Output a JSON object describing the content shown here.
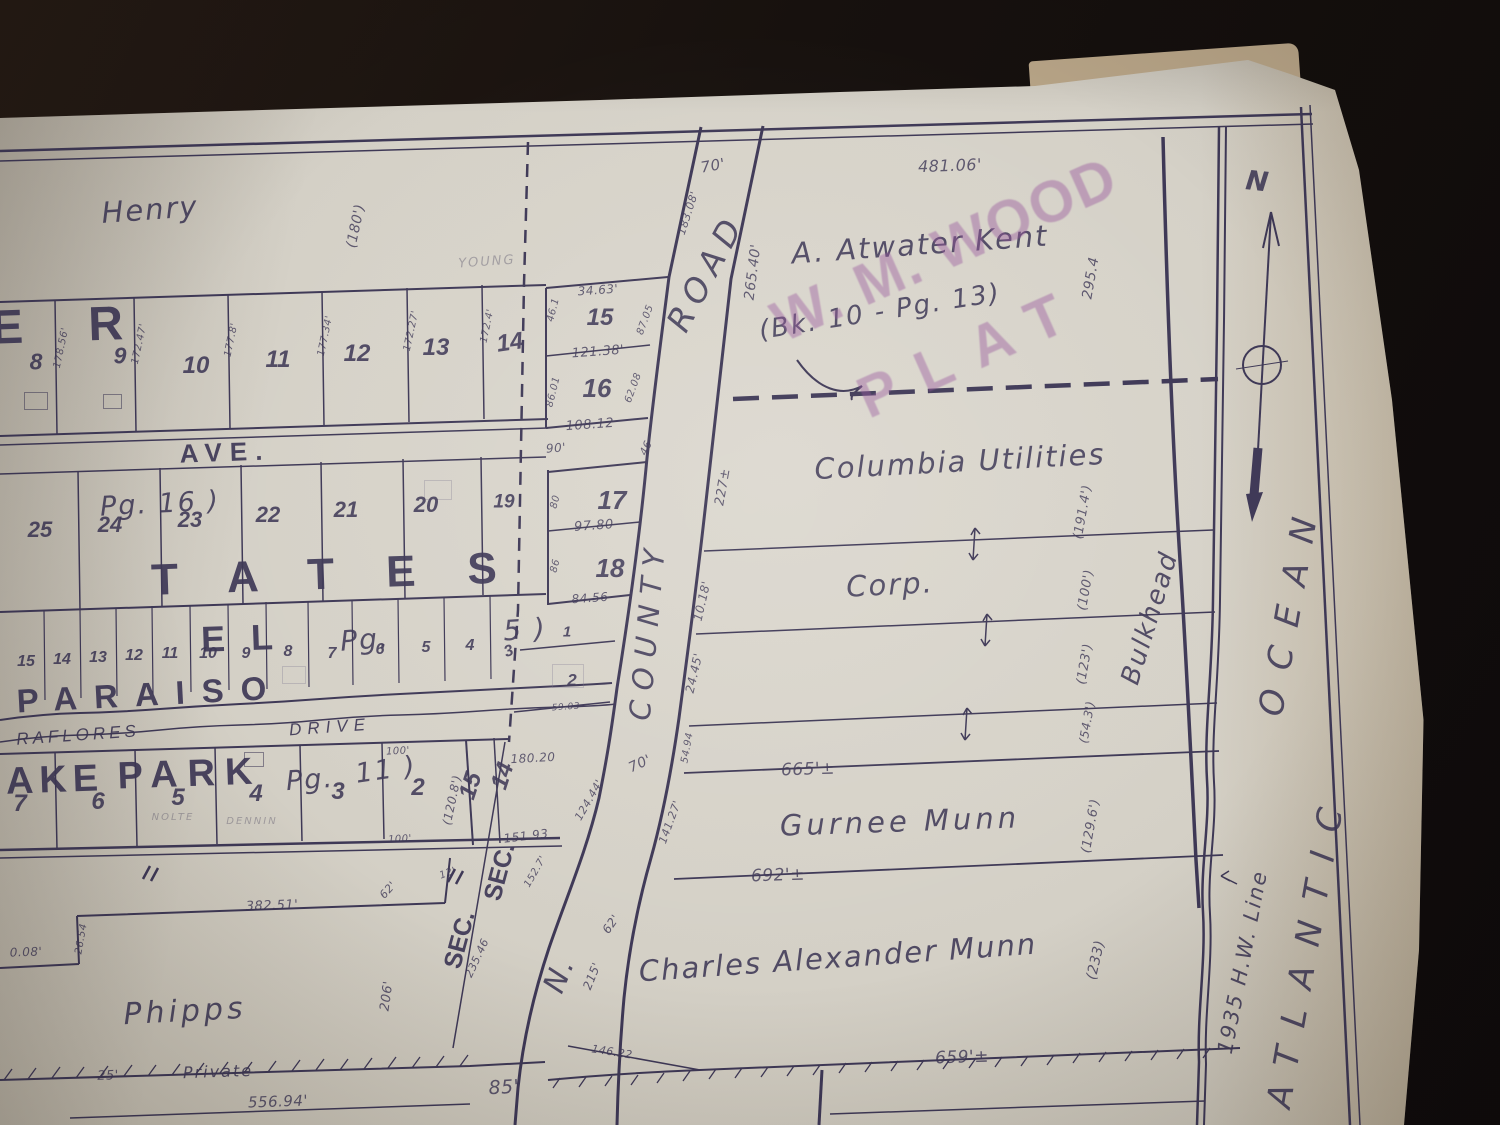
{
  "colors": {
    "ink": "#3e3856",
    "paper": "#d6d2c8",
    "stamp": "#96539b",
    "background": "#17110e",
    "pencil": "#6d6878"
  },
  "compass": {
    "north": "N"
  },
  "stamp": {
    "line1": "W. M. WOOD",
    "line2": "PLAT"
  },
  "labels": {
    "henry": "Henry",
    "er_fragment": "E R",
    "ave": "AVE.",
    "pg16": "Pg.  16 )",
    "tates": "TATES",
    "el": "EL",
    "pg5a": "Pg.",
    "pg5b": "5 )",
    "paraiso": "PARAISO",
    "miraflores": "RAFLORES",
    "drive": "DRIVE",
    "ake": "AKE",
    "park": "PARK",
    "pg11a": "Pg.",
    "pg11b": "11 )",
    "sec_a": "SEC.",
    "sec_b": "SEC.",
    "sec15": "15",
    "sec14": "14",
    "phipps": "Phipps",
    "private": "Private",
    "road2": "Road",
    "n_road": "N.",
    "county": "COUNTY",
    "road": "ROAD",
    "atwater": "A. Atwater Kent",
    "bk": "(Bk. 10 - Pg. 13)",
    "columbia": "Columbia Utilities",
    "corp": "Corp.",
    "gurnee": "Gurnee Munn",
    "charles": "Charles Alexander Munn",
    "bulkhead": "Bulkhead",
    "hw_line": "1935 H.W. Line",
    "atlantic": "ATLANTIC",
    "ocean": "OCEAN"
  },
  "lots": [
    {
      "t": "8",
      "x": 36,
      "y": 362,
      "s": 23
    },
    {
      "t": "9",
      "x": 120,
      "y": 356,
      "s": 23
    },
    {
      "t": "10",
      "x": 196,
      "y": 366,
      "s": 24
    },
    {
      "t": "11",
      "x": 278,
      "y": 360,
      "s": 24
    },
    {
      "t": "12",
      "x": 357,
      "y": 354,
      "s": 24
    },
    {
      "t": "13",
      "x": 436,
      "y": 348,
      "s": 24
    },
    {
      "t": "14",
      "x": 510,
      "y": 343,
      "r": -8,
      "s": 24
    },
    {
      "t": "15",
      "x": 600,
      "y": 318,
      "s": 24
    },
    {
      "t": "16",
      "x": 597,
      "y": 388,
      "s": 26
    },
    {
      "t": "17",
      "x": 612,
      "y": 500,
      "s": 26
    },
    {
      "t": "18",
      "x": 610,
      "y": 568,
      "s": 26
    },
    {
      "t": "25",
      "x": 40,
      "y": 530,
      "s": 22
    },
    {
      "t": "24",
      "x": 110,
      "y": 525,
      "s": 22
    },
    {
      "t": "23",
      "x": 190,
      "y": 520,
      "s": 22
    },
    {
      "t": "22",
      "x": 268,
      "y": 515,
      "s": 22
    },
    {
      "t": "21",
      "x": 346,
      "y": 510,
      "s": 22
    },
    {
      "t": "20",
      "x": 426,
      "y": 505,
      "s": 22
    },
    {
      "t": "19",
      "x": 504,
      "y": 502,
      "s": 19
    },
    {
      "t": "15",
      "x": 26,
      "y": 662,
      "s": 16
    },
    {
      "t": "14",
      "x": 62,
      "y": 660,
      "s": 16
    },
    {
      "t": "13",
      "x": 98,
      "y": 658,
      "s": 16
    },
    {
      "t": "12",
      "x": 134,
      "y": 656,
      "s": 16
    },
    {
      "t": "11",
      "x": 170,
      "y": 654,
      "s": 16
    },
    {
      "t": "10",
      "x": 208,
      "y": 654,
      "s": 16
    },
    {
      "t": "9",
      "x": 246,
      "y": 654,
      "s": 16
    },
    {
      "t": "8",
      "x": 288,
      "y": 652,
      "s": 16
    },
    {
      "t": "7",
      "x": 332,
      "y": 654,
      "s": 16
    },
    {
      "t": "6",
      "x": 380,
      "y": 650,
      "s": 16
    },
    {
      "t": "5",
      "x": 426,
      "y": 648,
      "s": 16
    },
    {
      "t": "4",
      "x": 470,
      "y": 646,
      "s": 16
    },
    {
      "t": "3",
      "x": 509,
      "y": 652,
      "r": -20,
      "s": 16
    },
    {
      "t": "1",
      "x": 567,
      "y": 632,
      "s": 15
    },
    {
      "t": "2",
      "x": 572,
      "y": 680,
      "s": 17
    },
    {
      "t": "7",
      "x": 20,
      "y": 804,
      "s": 24
    },
    {
      "t": "6",
      "x": 98,
      "y": 802,
      "s": 24
    },
    {
      "t": "5",
      "x": 178,
      "y": 798,
      "s": 24
    },
    {
      "t": "4",
      "x": 256,
      "y": 794,
      "s": 24
    },
    {
      "t": "3",
      "x": 338,
      "y": 792,
      "s": 24
    },
    {
      "t": "2",
      "x": 418,
      "y": 788,
      "s": 24
    }
  ],
  "dims": [
    {
      "t": "481.06'",
      "x": 950,
      "y": 166,
      "r": -2,
      "s": 16
    },
    {
      "t": "70'",
      "x": 713,
      "y": 166,
      "r": -10,
      "s": 15
    },
    {
      "t": "183.08'",
      "x": 688,
      "y": 213,
      "r": -72,
      "s": 11
    },
    {
      "t": "265.40'",
      "x": 753,
      "y": 272,
      "r": -83,
      "s": 14
    },
    {
      "t": "295.4",
      "x": 1091,
      "y": 278,
      "r": -80,
      "s": 14
    },
    {
      "t": "227±",
      "x": 723,
      "y": 487,
      "r": -80,
      "s": 13
    },
    {
      "t": "10.18'",
      "x": 702,
      "y": 601,
      "r": -77,
      "s": 12
    },
    {
      "t": "24.45'",
      "x": 694,
      "y": 673,
      "r": -77,
      "s": 12
    },
    {
      "t": "54.94",
      "x": 688,
      "y": 748,
      "r": -80,
      "s": 10
    },
    {
      "t": "70'",
      "x": 640,
      "y": 764,
      "r": -25,
      "s": 14
    },
    {
      "t": "141.27'",
      "x": 670,
      "y": 822,
      "r": -70,
      "s": 11
    },
    {
      "t": "62'",
      "x": 611,
      "y": 924,
      "r": -55,
      "s": 12
    },
    {
      "t": "215'",
      "x": 592,
      "y": 976,
      "r": -68,
      "s": 12
    },
    {
      "t": "152.7'",
      "x": 536,
      "y": 872,
      "r": -60,
      "s": 10
    },
    {
      "t": "235.46",
      "x": 477,
      "y": 958,
      "r": -65,
      "s": 11
    },
    {
      "t": "146.22",
      "x": 612,
      "y": 1052,
      "r": 9,
      "s": 11
    },
    {
      "t": "85'",
      "x": 504,
      "y": 1088,
      "r": -3,
      "s": 19
    },
    {
      "t": "659'±",
      "x": 962,
      "y": 1058,
      "r": -2,
      "s": 17
    },
    {
      "t": "665'±",
      "x": 808,
      "y": 770,
      "r": -2,
      "s": 17
    },
    {
      "t": "692'±",
      "x": 778,
      "y": 876,
      "r": -2,
      "s": 17
    },
    {
      "t": "(233)",
      "x": 1096,
      "y": 960,
      "r": -77,
      "s": 14
    },
    {
      "t": "(191.4')",
      "x": 1083,
      "y": 512,
      "r": -80,
      "s": 13
    },
    {
      "t": "(100')",
      "x": 1086,
      "y": 590,
      "r": -80,
      "s": 13
    },
    {
      "t": "(123')",
      "x": 1085,
      "y": 664,
      "r": -80,
      "s": 13
    },
    {
      "t": "(54.3')",
      "x": 1087,
      "y": 722,
      "r": -80,
      "s": 12
    },
    {
      "t": "(129.6')",
      "x": 1091,
      "y": 826,
      "r": -80,
      "s": 13
    },
    {
      "t": "(180')",
      "x": 356,
      "y": 226,
      "r": -78,
      "s": 14
    },
    {
      "t": "34.63'",
      "x": 598,
      "y": 290,
      "r": -4,
      "s": 12
    },
    {
      "t": "121.38'",
      "x": 598,
      "y": 352,
      "r": -4,
      "s": 13
    },
    {
      "t": "108.12",
      "x": 590,
      "y": 425,
      "r": -4,
      "s": 13
    },
    {
      "t": "86.01",
      "x": 554,
      "y": 392,
      "r": -76,
      "s": 10
    },
    {
      "t": "62.08",
      "x": 634,
      "y": 388,
      "r": -70,
      "s": 10
    },
    {
      "t": "87.05",
      "x": 646,
      "y": 320,
      "r": -70,
      "s": 10
    },
    {
      "t": "46.1",
      "x": 554,
      "y": 310,
      "r": -76,
      "s": 10
    },
    {
      "t": "90'",
      "x": 556,
      "y": 448,
      "r": -4,
      "s": 12
    },
    {
      "t": "80",
      "x": 556,
      "y": 502,
      "r": -76,
      "s": 10
    },
    {
      "t": "97.80",
      "x": 594,
      "y": 526,
      "r": -4,
      "s": 13
    },
    {
      "t": "86",
      "x": 556,
      "y": 566,
      "r": -76,
      "s": 10
    },
    {
      "t": "84.56",
      "x": 590,
      "y": 598,
      "r": -4,
      "s": 12
    },
    {
      "t": "46",
      "x": 646,
      "y": 448,
      "r": -65,
      "s": 11
    },
    {
      "t": "178.56'",
      "x": 62,
      "y": 348,
      "r": -78,
      "s": 10
    },
    {
      "t": "172.47'",
      "x": 140,
      "y": 344,
      "r": -78,
      "s": 10
    },
    {
      "t": "177.8'",
      "x": 232,
      "y": 340,
      "r": -78,
      "s": 10
    },
    {
      "t": "177.34'",
      "x": 326,
      "y": 336,
      "r": -78,
      "s": 10
    },
    {
      "t": "172.27'",
      "x": 412,
      "y": 331,
      "r": -78,
      "s": 10
    },
    {
      "t": "172.4'",
      "x": 488,
      "y": 326,
      "r": -78,
      "s": 10
    },
    {
      "t": "100'",
      "x": 398,
      "y": 752,
      "r": -3,
      "s": 10
    },
    {
      "t": "(120.8')",
      "x": 452,
      "y": 800,
      "r": -78,
      "s": 12
    },
    {
      "t": "100'",
      "x": 400,
      "y": 840,
      "r": -3,
      "s": 10
    },
    {
      "t": "180.20",
      "x": 533,
      "y": 758,
      "r": -3,
      "s": 12
    },
    {
      "t": "151.93",
      "x": 526,
      "y": 836,
      "r": -7,
      "s": 12
    },
    {
      "t": "124.44'",
      "x": 589,
      "y": 800,
      "r": -60,
      "s": 11
    },
    {
      "t": "59.03",
      "x": 566,
      "y": 708,
      "r": -4,
      "s": 9
    },
    {
      "t": "382.51'",
      "x": 272,
      "y": 906,
      "r": -2,
      "s": 13
    },
    {
      "t": "26.54",
      "x": 82,
      "y": 939,
      "r": -80,
      "s": 10
    },
    {
      "t": "0.08'",
      "x": 26,
      "y": 952,
      "r": -2,
      "s": 12
    },
    {
      "t": "62'",
      "x": 388,
      "y": 890,
      "r": -48,
      "s": 11
    },
    {
      "t": "206'",
      "x": 387,
      "y": 996,
      "r": -82,
      "s": 13
    },
    {
      "t": "12'",
      "x": 448,
      "y": 874,
      "r": -20,
      "s": 10
    },
    {
      "t": "25'",
      "x": 108,
      "y": 1076,
      "r": -2,
      "s": 13
    },
    {
      "t": "556.94'",
      "x": 278,
      "y": 1102,
      "r": -2,
      "s": 15
    }
  ],
  "pencil": [
    {
      "t": "YOUNG",
      "x": 487,
      "y": 262,
      "r": -4,
      "s": 13
    },
    {
      "t": "NOLTE",
      "x": 173,
      "y": 818,
      "r": 0,
      "s": 10
    },
    {
      "t": "DENNIN",
      "x": 252,
      "y": 822,
      "r": 0,
      "s": 10
    }
  ],
  "buildings": [
    {
      "x": 24,
      "y": 392,
      "w": 22,
      "h": 16,
      "p": false
    },
    {
      "x": 103,
      "y": 394,
      "w": 17,
      "h": 13,
      "p": false
    },
    {
      "x": 424,
      "y": 480,
      "w": 26,
      "h": 18,
      "p": true
    },
    {
      "x": 282,
      "y": 666,
      "w": 22,
      "h": 16,
      "p": true
    },
    {
      "x": 244,
      "y": 752,
      "w": 18,
      "h": 13,
      "p": false
    },
    {
      "x": 552,
      "y": 664,
      "w": 30,
      "h": 22,
      "p": true
    }
  ]
}
